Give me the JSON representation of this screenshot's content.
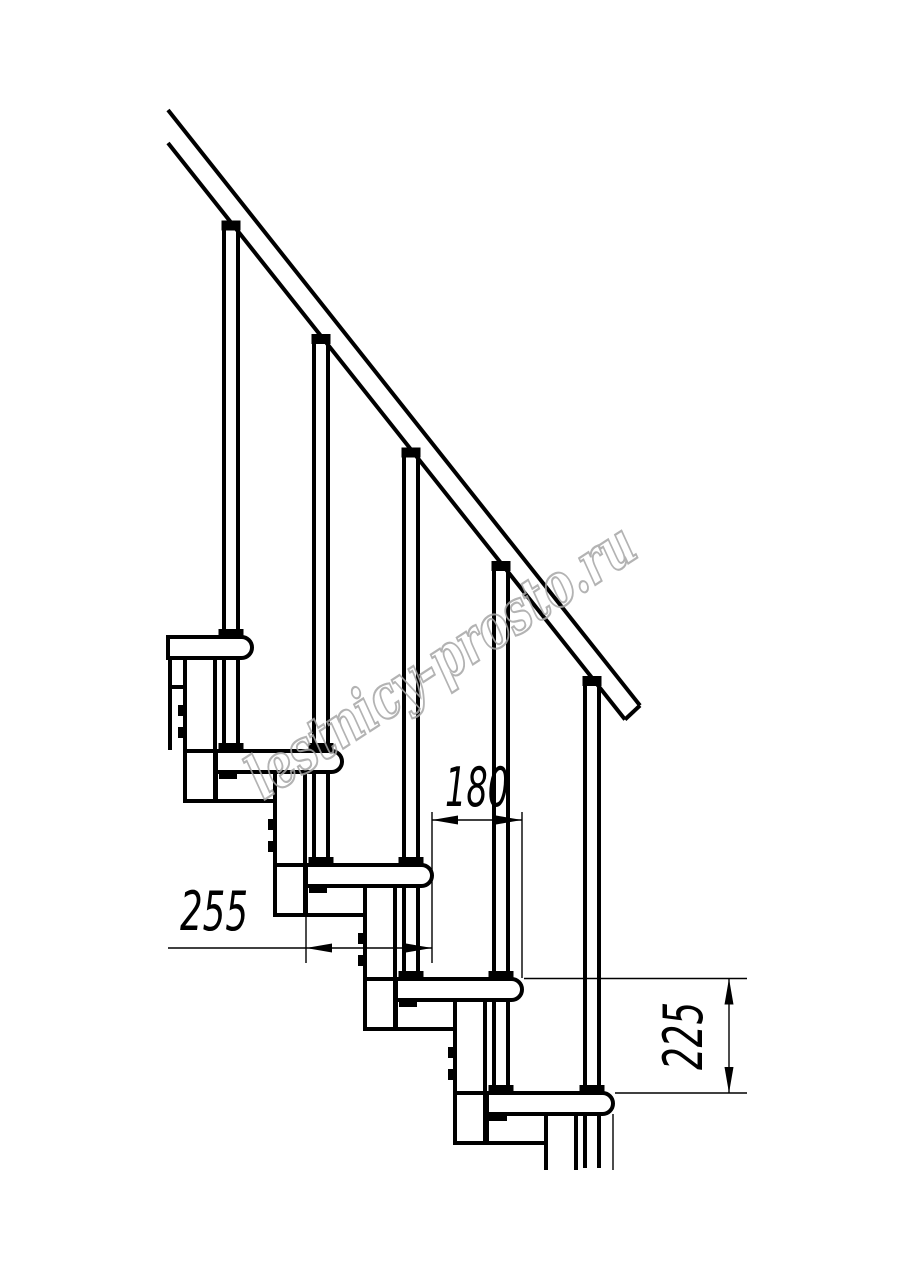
{
  "document": {
    "type": "technical line drawing",
    "subject": "modular staircase side elevation with handrail, balusters, treads and stringer modules",
    "background_color": "#ffffff",
    "line_color": "#000000",
    "treads_visible": 5,
    "balusters_visible": 5
  },
  "dimensions": {
    "going": "180",
    "tread_depth": "255",
    "rise": "225"
  },
  "watermark": {
    "text": "lestnicy-prosto.ru",
    "color": "#a6a6a6"
  }
}
